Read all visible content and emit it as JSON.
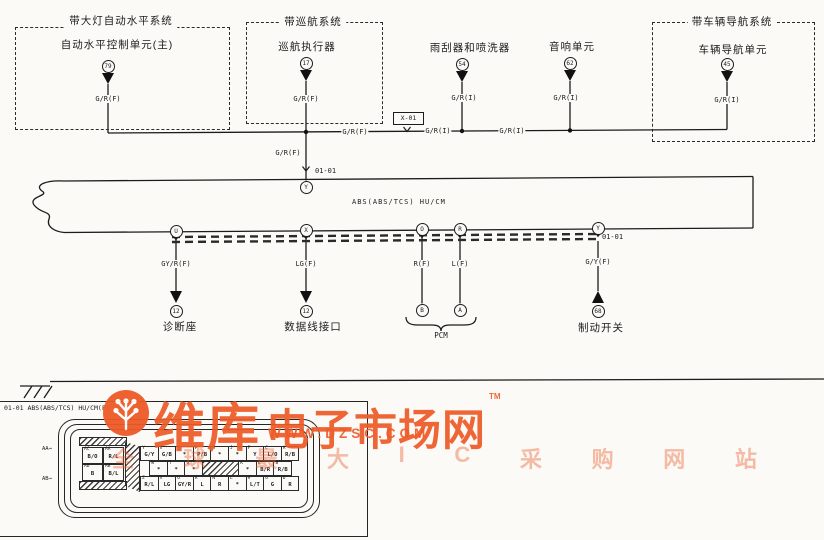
{
  "diagram": {
    "systems": {
      "headlamp": {
        "title": "带大灯自动水平系统",
        "unit": "自动水平控制单元(主)",
        "pin": "79",
        "wire_label": "G/R(F)"
      },
      "cruise": {
        "title": "带巡航系统",
        "unit": "巡航执行器",
        "pin": "17",
        "wire_label": "G/R(F)",
        "lower_wire_label": "G/R(F)"
      },
      "nav": {
        "title": "带车辆导航系统",
        "unit": "车辆导航单元",
        "pin": "45",
        "wire_label": "G/R(I)"
      }
    },
    "components": {
      "wiper": {
        "name": "雨刮器和喷洗器",
        "pin": "54",
        "wire_label": "G/R(I)"
      },
      "audio": {
        "name": "音响单元",
        "pin": "62",
        "wire_label": "G/R(I)"
      }
    },
    "main_wire": {
      "label_left": "G/R(F)",
      "label_mid": "G/R(I)",
      "label_right": "G/R(I)"
    },
    "junction_x01": {
      "ref": "X-01"
    },
    "bus": {
      "label": "ABS(ABS/TCS) HU/CM",
      "top_pin": "Y",
      "top_ref": "01-01",
      "bottom_pins": {
        "u": "U",
        "x": "X",
        "o": "O",
        "r": "R",
        "y": "Y"
      },
      "edge_ref": "01-01"
    },
    "bottom": {
      "diag": {
        "name": "诊断座",
        "wire_label": "GY/R(F)",
        "pin": "12"
      },
      "datalink": {
        "name": "数据线接口",
        "wire_label": "LG(F)",
        "pin": "12"
      },
      "pcm": {
        "name": "PCM",
        "wire_label_b": "R(F)",
        "wire_label_a": "L(F)",
        "pin_b": "B",
        "pin_a": "A"
      },
      "brake": {
        "name": "制动开关",
        "wire_label": "G/Y(F)",
        "pin": "68"
      }
    },
    "pinout": {
      "title": "01-01 ABS(ABS/TCS) HU/CM(F)",
      "side_marker_top": "AA",
      "side_marker_bottom": "AB",
      "side_block": {
        "rows": [
          [
            {
              "pin": "AC",
              "color": "B/O"
            },
            {
              "pin": "AA",
              "color": "R/L"
            }
          ],
          [
            {
              "pin": "AD",
              "color": "B"
            },
            {
              "pin": "AB",
              "color": "B/L"
            }
          ]
        ]
      },
      "rows": [
        {
          "cells": [
            {
              "pin": "Y",
              "color": "G/Y"
            },
            {
              "pin": "V",
              "color": "G/B"
            },
            {
              "pin": "S",
              "color": "*"
            },
            {
              "pin": "P",
              "color": "P/B"
            },
            {
              "pin": "M",
              "color": "*"
            },
            {
              "pin": "J",
              "color": "*"
            },
            {
              "pin": "F",
              "color": "Y"
            },
            {
              "pin": "C",
              "color": "L/O"
            },
            {
              "pin": "A",
              "color": "R/B"
            }
          ]
        },
        {
          "cells": [
            {
              "pin": "W",
              "color": "*"
            },
            {
              "pin": "T",
              "color": "*"
            },
            {
              "pin": "Q",
              "color": "*"
            },
            {
              "pin": "",
              "color": "",
              "hatch": true
            },
            {
              "pin": "K",
              "color": "*"
            },
            {
              "pin": "E",
              "color": "B/R"
            },
            {
              "pin": "B",
              "color": "R/B"
            }
          ]
        },
        {
          "cells": [
            {
              "pin": "Z",
              "color": "R/L"
            },
            {
              "pin": "X",
              "color": "LG"
            },
            {
              "pin": "U",
              "color": "GY/R"
            },
            {
              "pin": "R",
              "color": "L"
            },
            {
              "pin": "N",
              "color": "R"
            },
            {
              "pin": "L",
              "color": "*"
            },
            {
              "pin": "H",
              "color": "L/T"
            },
            {
              "pin": "G",
              "color": "G"
            },
            {
              "pin": "D",
              "color": "R"
            }
          ]
        }
      ]
    }
  },
  "watermark": {
    "brand_big": "维库",
    "brand_rest": "电子市场网",
    "tm": "TM",
    "url": "WWW.DZSC.COM",
    "tagline": "全球最大IC采购网站",
    "color": "#ee5a28"
  }
}
